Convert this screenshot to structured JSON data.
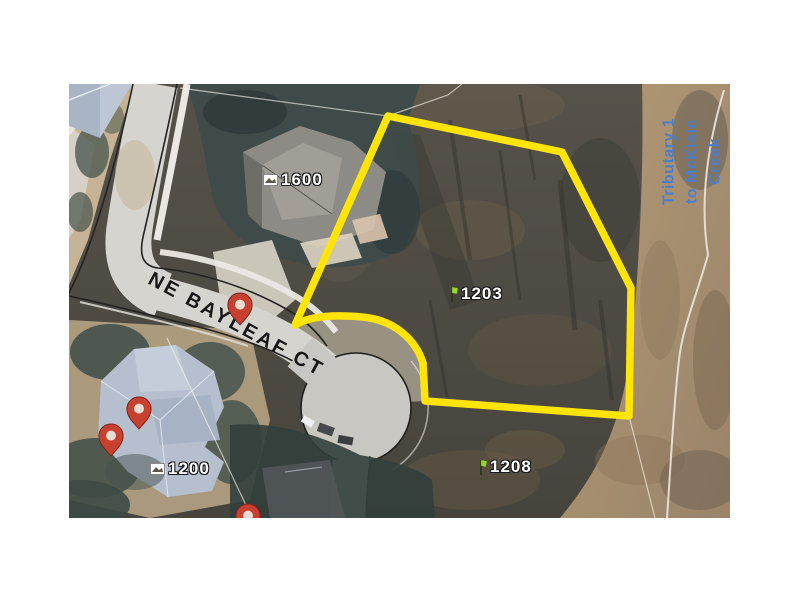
{
  "map": {
    "street_label": "NE BAYLEAF CT",
    "waterway_label": {
      "lines": [
        "Tributary 1",
        "to McKisic",
        "Creek"
      ],
      "color": "#4d7ec9"
    },
    "parcel_highlight_color": "#ffe408",
    "parcel_labels": [
      {
        "text": "1600",
        "icon": "photo",
        "x": 263,
        "y": 180
      },
      {
        "text": "1203",
        "icon": "flag",
        "x": 446,
        "y": 294
      },
      {
        "text": "1208",
        "icon": "flag",
        "x": 475,
        "y": 467
      },
      {
        "text": "1200",
        "icon": "photo",
        "x": 150,
        "y": 469
      }
    ],
    "pins": [
      {
        "x": 240,
        "y": 326
      },
      {
        "x": 139,
        "y": 430
      },
      {
        "x": 111,
        "y": 457
      },
      {
        "x": 248,
        "y": 537
      }
    ]
  }
}
